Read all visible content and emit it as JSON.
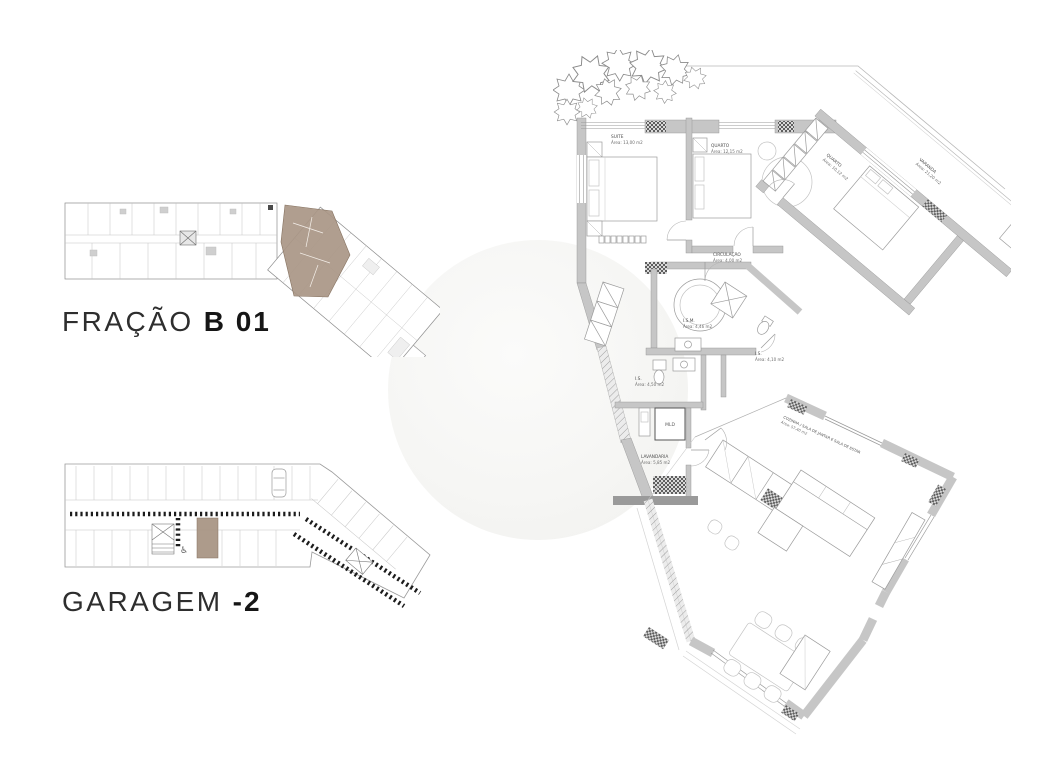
{
  "page_background": "#ffffff",
  "highlight_color": "#a99685",
  "overview": {
    "title_light": "FRAÇÃO",
    "title_bold": "B 01"
  },
  "garage": {
    "title_light": "GARAGEM",
    "title_bold": "-2",
    "accessible_symbol": "♿"
  },
  "plan": {
    "suite": {
      "name": "SUITE",
      "area": "Área: 13,00 m2"
    },
    "quarto2": {
      "name": "QUARTO",
      "area": "Área: 12,15 m2"
    },
    "quarto3": {
      "name": "QUARTO",
      "area": "Área: 10,12 m2"
    },
    "varanda": {
      "name": "VARANDA",
      "area": "Área: 21,20 m2"
    },
    "circulacao": {
      "name": "CIRCULAÇÃO",
      "area": "Área: 4,00 m2"
    },
    "ism": {
      "name": "I.S.M.",
      "area": "Área: 4,46 m2"
    },
    "is_suite": {
      "name": "I.S.",
      "area": "Área: 4,50 m2"
    },
    "is2": {
      "name": "I.S.",
      "area": "Área: 4,10 m2"
    },
    "lavandaria": {
      "name": "LAVANDARIA",
      "area": "Área: 5,85 m2"
    },
    "sala": {
      "name": "COZINHA / SALA DE JANTAR E SALA DE ESTAR",
      "area": "Área: 57,40 m2"
    },
    "ac_label": "A/C",
    "mld_label": "MLD"
  }
}
